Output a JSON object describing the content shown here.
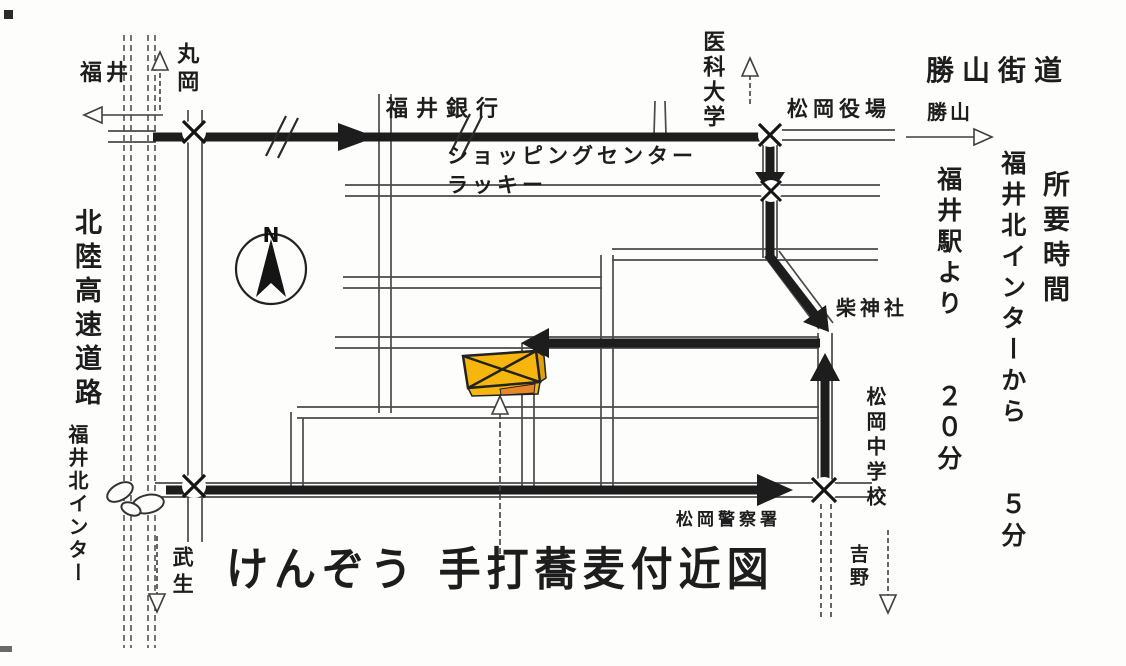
{
  "title": "けんぞう 手打蕎麦付近図",
  "compass": {
    "north_label": "N"
  },
  "labels": {
    "fukui": "福井",
    "maruoka": "丸岡",
    "fukui_bank": "福井銀行",
    "shopping_center": "ショッピングセンター",
    "lucky": "ラッキー",
    "ika_daigaku": "医科大学",
    "matsuoka_yakuba": "松岡役場",
    "katsuyama_kaido": "勝山街道",
    "katsuyama": "勝山",
    "hokuriku_expressway": "北陸高速道路",
    "fukui_kita_ic": "福井北インター",
    "takefu": "武生",
    "shiba_jinja": "柴神社",
    "matsuoka_jhs": "松岡中学校",
    "matsuoka_police": "松岡警察署",
    "yoshino": "吉野"
  },
  "info": {
    "shoyo_jikan": "所要時間",
    "from_ic": "福井北インターから　　５分",
    "from_station": "福井駅より　　２０分"
  },
  "colors": {
    "building_fill": "#F6B60D",
    "building_side": "#DFA20C",
    "building_accent": "#E8862B",
    "route_ink": "#1d1d1d",
    "road_line": "#4a4a4a",
    "paper": "#FDFDFC"
  }
}
